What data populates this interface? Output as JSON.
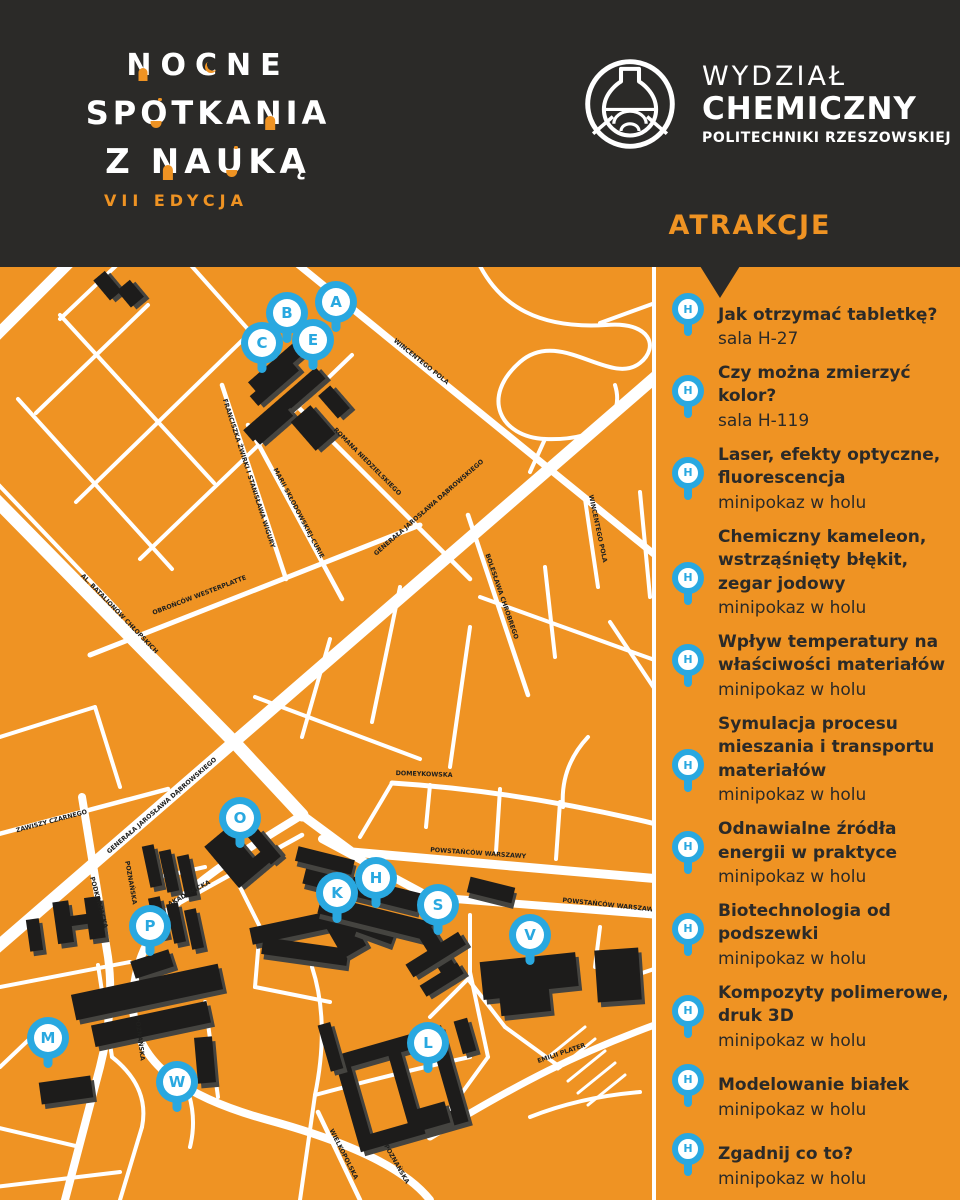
{
  "colors": {
    "orange": "#EF9323",
    "dark": "#2B2A28",
    "blue": "#29A8E0",
    "building": "#1D1C1B",
    "building_shadow": "#454440",
    "street": "#FFFFFF"
  },
  "header": {
    "logo": {
      "line1_chars": [
        "N",
        "O",
        "C",
        "N",
        "E"
      ],
      "line2_chars": [
        "S",
        "P",
        "O",
        "T",
        "K",
        "A",
        "N",
        "I",
        "A"
      ],
      "line3_z": "Z",
      "line3_chars": [
        "N",
        "A",
        "U",
        "K",
        "Ą"
      ],
      "edition": "VII EDYCJA"
    },
    "faculty": {
      "line1": "WYDZIAŁ",
      "line2": "CHEMICZNY",
      "line3": "POLITECHNIKI RZESZOWSKIEJ"
    },
    "attractions_heading": "ATRAKCJE"
  },
  "map": {
    "streets": [
      "AL. BATALIONÓW CHŁOPSKICH",
      "GENERAŁA JAROSŁAWA DĄBROWSKIEGO",
      "POWSTAŃCÓW WARSZAWY",
      "POZNAŃSKA",
      "PODKARPACKA",
      "AKADEMICKA",
      "ZAWISZY CZARNEGO",
      "WINCENTEGO POLA",
      "OBROŃCÓW WESTERPLATTE",
      "ROMANA NIEDZIELSKIEGO",
      "MARII SKŁODOWSKIEJ-CURIE",
      "FRANCISZKA ŻWIRKI I STANISŁAWA WIGURY",
      "BOLESŁAWA CHROBREGO",
      "DOMEYKOWSKA",
      "EMILII PLATER",
      "WIELKOPOLSKA"
    ],
    "pins": [
      {
        "letter": "A"
      },
      {
        "letter": "B"
      },
      {
        "letter": "C"
      },
      {
        "letter": "E"
      },
      {
        "letter": "O"
      },
      {
        "letter": "P"
      },
      {
        "letter": "M"
      },
      {
        "letter": "W"
      },
      {
        "letter": "K"
      },
      {
        "letter": "H"
      },
      {
        "letter": "S"
      },
      {
        "letter": "V"
      },
      {
        "letter": "L"
      }
    ]
  },
  "sidebar": {
    "pin_letter": "H",
    "items": [
      {
        "title": "Jak otrzymać tabletkę?",
        "location": "sala H-27"
      },
      {
        "title": "Czy można zmierzyć kolor?",
        "location": "sala H-119"
      },
      {
        "title": "Laser, efekty optyczne,\nfluorescencja",
        "location": "minipokaz w holu"
      },
      {
        "title": "Chemiczny kameleon,\nwstrząśnięty błękit,\nzegar jodowy",
        "location": "minipokaz w holu"
      },
      {
        "title": "Wpływ temperatury na\nwłaściwości materiałów",
        "location": "minipokaz w holu"
      },
      {
        "title": "Symulacja procesu\nmieszania i transportu\nmateriałów",
        "location": "minipokaz w holu"
      },
      {
        "title": "Odnawialne źródła\nenergii w praktyce",
        "location": "minipokaz w holu"
      },
      {
        "title": "Biotechnologia od\npodszewki",
        "location": "minipokaz w holu"
      },
      {
        "title": "Kompozyty polimerowe,\ndruk 3D",
        "location": "minipokaz w holu"
      },
      {
        "title": "Modelowanie białek",
        "location": "minipokaz w holu"
      },
      {
        "title": "Zgadnij co to?",
        "location": "minipokaz w holu"
      }
    ]
  }
}
